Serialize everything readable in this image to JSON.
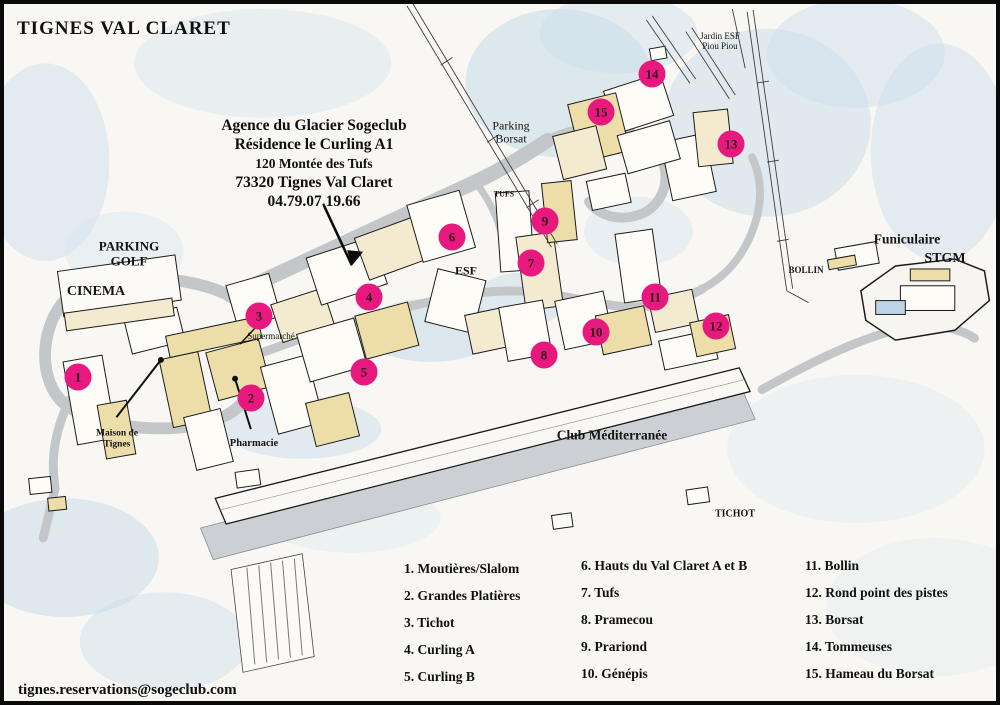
{
  "title": "TIGNES VAL CLARET",
  "agency": {
    "lines": [
      "Agence du Glacier Sogeclub",
      "Résidence le Curling A1",
      "120 Montée des Tufs",
      "73320 Tignes Val Claret",
      "04.79.07.19.66"
    ]
  },
  "contact_email": "tignes.reservations@sogeclub.com",
  "map": {
    "labels": [
      {
        "id": "parking-golf",
        "lines": [
          "PARKING",
          "GOLF"
        ],
        "x": 125,
        "y": 250,
        "size": 13,
        "bold": true
      },
      {
        "id": "cinema",
        "lines": [
          "CINEMA"
        ],
        "x": 92,
        "y": 288,
        "size": 14,
        "bold": true
      },
      {
        "id": "parking-borsat",
        "lines": [
          "Parking",
          "Borsat"
        ],
        "x": 507,
        "y": 129,
        "size": 12,
        "bold": false
      },
      {
        "id": "jardin-esf-piou-piou",
        "lines": [
          "Jardin ESF",
          "Piou Piou"
        ],
        "x": 716,
        "y": 37,
        "size": 9,
        "bold": false
      },
      {
        "id": "tufs-lift-station",
        "lines": [
          "TUFS"
        ],
        "x": 500,
        "y": 191,
        "size": 8,
        "bold": true
      },
      {
        "id": "esf",
        "lines": [
          "ESF"
        ],
        "x": 462,
        "y": 267,
        "size": 12,
        "bold": true
      },
      {
        "id": "supermarche",
        "lines": [
          "Supermarché"
        ],
        "x": 267,
        "y": 332,
        "size": 9,
        "bold": false
      },
      {
        "id": "maison-de-tignes",
        "lines": [
          "Maison de",
          "Tignes"
        ],
        "x": 113,
        "y": 435,
        "size": 9.5,
        "bold": true
      },
      {
        "id": "pharmacie",
        "lines": [
          "Pharmacie"
        ],
        "x": 250,
        "y": 440,
        "size": 10.5,
        "bold": true
      },
      {
        "id": "club-mediterranee",
        "lines": [
          "Club Méditerranée"
        ],
        "x": 608,
        "y": 431,
        "size": 13.5,
        "bold": true
      },
      {
        "id": "tichot",
        "lines": [
          "TICHOT"
        ],
        "x": 731,
        "y": 510,
        "size": 10,
        "bold": true
      },
      {
        "id": "funiculaire",
        "lines": [
          "Funiculaire"
        ],
        "x": 903,
        "y": 235,
        "size": 13.5,
        "bold": true
      },
      {
        "id": "stgm",
        "lines": [
          "STGM"
        ],
        "x": 941,
        "y": 255,
        "size": 14,
        "bold": true
      },
      {
        "id": "bollin",
        "lines": [
          "BOLLIN"
        ],
        "x": 802,
        "y": 266,
        "size": 9,
        "bold": true
      }
    ],
    "markers": [
      {
        "num": "1",
        "x": 74,
        "y": 373
      },
      {
        "num": "2",
        "x": 247,
        "y": 394
      },
      {
        "num": "3",
        "x": 255,
        "y": 312
      },
      {
        "num": "4",
        "x": 365,
        "y": 293
      },
      {
        "num": "5",
        "x": 360,
        "y": 368
      },
      {
        "num": "6",
        "x": 448,
        "y": 233
      },
      {
        "num": "7",
        "x": 527,
        "y": 259
      },
      {
        "num": "8",
        "x": 540,
        "y": 351
      },
      {
        "num": "9",
        "x": 541,
        "y": 217
      },
      {
        "num": "10",
        "x": 592,
        "y": 328
      },
      {
        "num": "11",
        "x": 651,
        "y": 293
      },
      {
        "num": "12",
        "x": 712,
        "y": 322
      },
      {
        "num": "13",
        "x": 727,
        "y": 140
      },
      {
        "num": "14",
        "x": 648,
        "y": 70
      },
      {
        "num": "15",
        "x": 597,
        "y": 108
      }
    ]
  },
  "legend": {
    "columns": [
      {
        "items": [
          {
            "num": "1",
            "label": "Moutières/Slalom"
          },
          {
            "num": "2",
            "label": "Grandes Platières"
          },
          {
            "num": "3",
            "label": "Tichot"
          },
          {
            "num": "4",
            "label": "Curling A"
          },
          {
            "num": "5",
            "label": "Curling B"
          }
        ]
      },
      {
        "items": [
          {
            "num": "6",
            "label": "Hauts du Val Claret A et B"
          },
          {
            "num": "7",
            "label": "Tufs"
          },
          {
            "num": "8",
            "label": "Pramecou"
          },
          {
            "num": "9",
            "label": "Prariond"
          },
          {
            "num": "10",
            "label": "Génépis"
          }
        ]
      },
      {
        "items": [
          {
            "num": "11",
            "label": "Bollin"
          },
          {
            "num": "12",
            "label": "Rond point des pistes"
          },
          {
            "num": "13",
            "label": "Borsat"
          },
          {
            "num": "14",
            "label": "Tommeuses"
          },
          {
            "num": "15",
            "label": "Hameau du Borsat"
          }
        ]
      }
    ]
  },
  "colors": {
    "marker_fill": "#e8197e",
    "ink": "#111111"
  }
}
